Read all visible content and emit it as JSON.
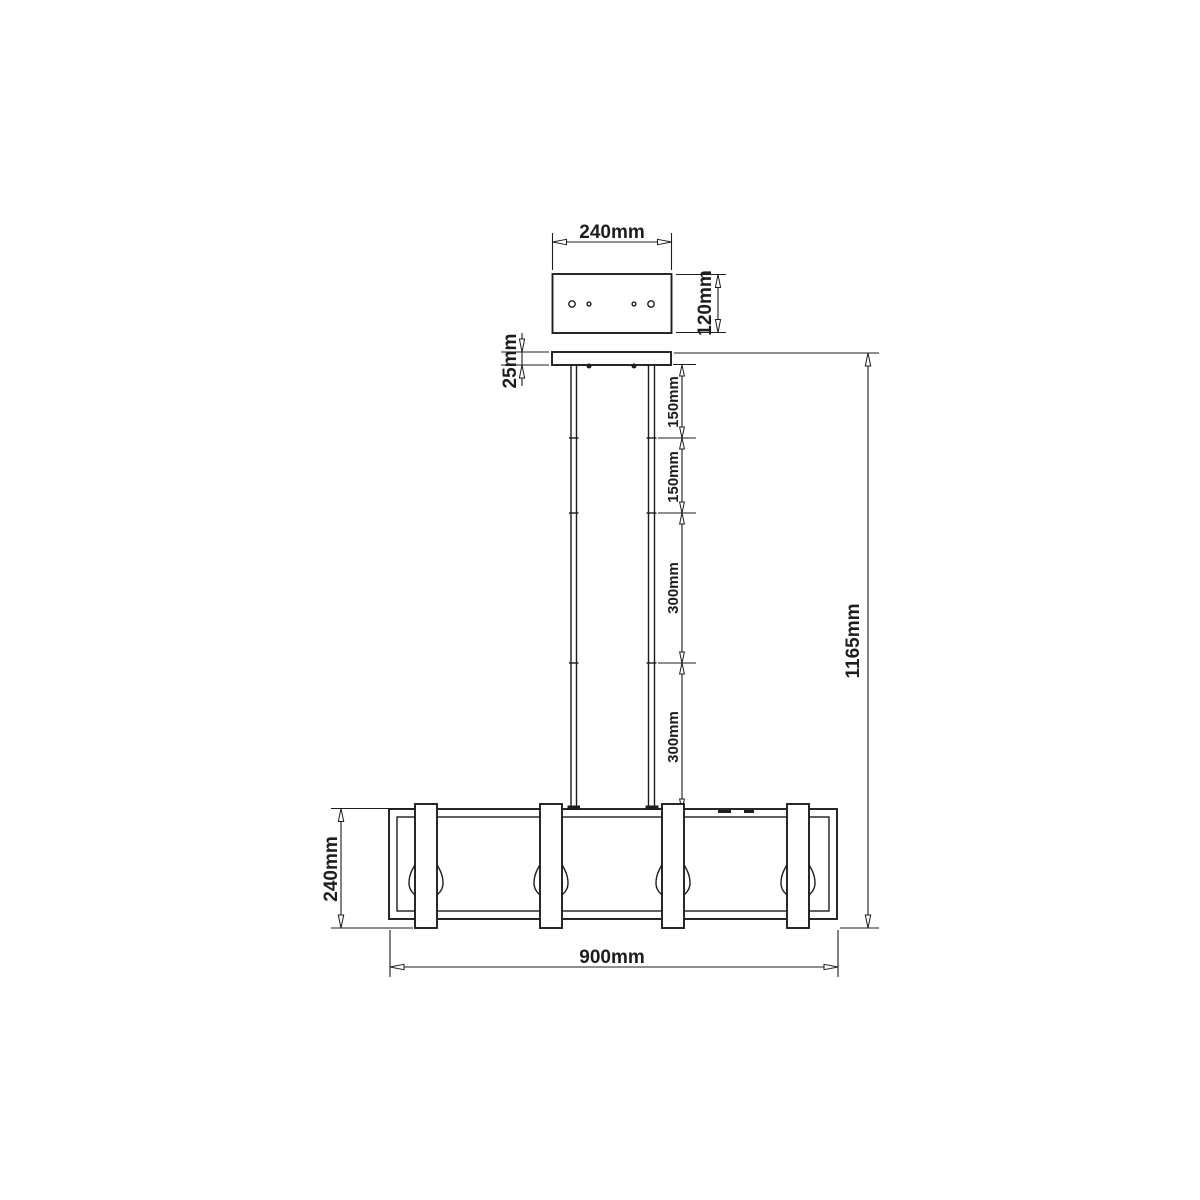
{
  "drawing": {
    "kind": "technical dimension drawing",
    "colors": {
      "line": "#1d1d1b",
      "background": "#ffffff"
    },
    "dimensions": {
      "canopy_width": "240mm",
      "canopy_height": "120mm",
      "canopy_plate_thickness": "25mm",
      "rod_segments": [
        "150mm",
        "150mm",
        "300mm",
        "300mm"
      ],
      "overall_height": "1165mm",
      "frame_height": "240mm",
      "frame_width": "900mm"
    },
    "features": {
      "canopy_hole_count": 4,
      "suspension_rod_count": 2,
      "strap_count": 4,
      "bulb_count": 4
    }
  }
}
